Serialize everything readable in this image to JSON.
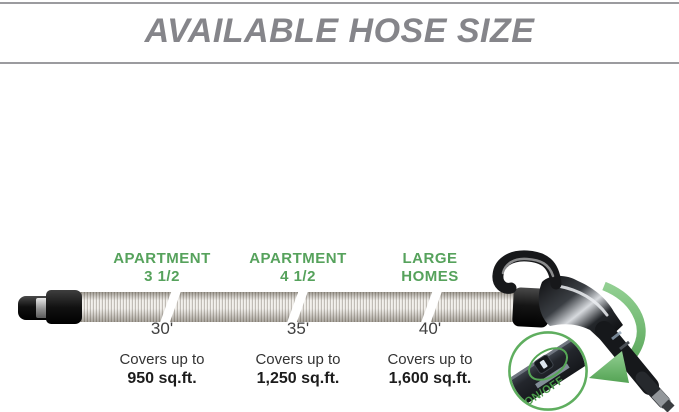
{
  "header": {
    "title": "AVAILABLE HOSE SIZE"
  },
  "hose_options": [
    {
      "name_line1": "APARTMENT",
      "name_line2": "3 1/2",
      "length": "30'",
      "covers_prefix": "Covers up to",
      "covers_value": "950 sq.ft."
    },
    {
      "name_line1": "APARTMENT",
      "name_line2": "4 1/2",
      "length": "35'",
      "covers_prefix": "Covers up to",
      "covers_value": "1,250 sq.ft."
    },
    {
      "name_line1": "LARGE",
      "name_line2": "HOMES",
      "length": "40'",
      "covers_prefix": "Covers up to",
      "covers_value": "1,600 sq.ft."
    }
  ],
  "inset": {
    "switch_label": "ON/OFF"
  },
  "icons": {
    "handle": "vacuum-handle-illustration",
    "arrow": "zoom-arrow-icon",
    "inset": "onoff-switch-inset"
  },
  "colors": {
    "accent_green": "#56A25C",
    "arrow_green": "#6CB96C",
    "title_gray": "#85858A",
    "rule_gray": "#9B9B9F",
    "text_dark": "#333333"
  }
}
